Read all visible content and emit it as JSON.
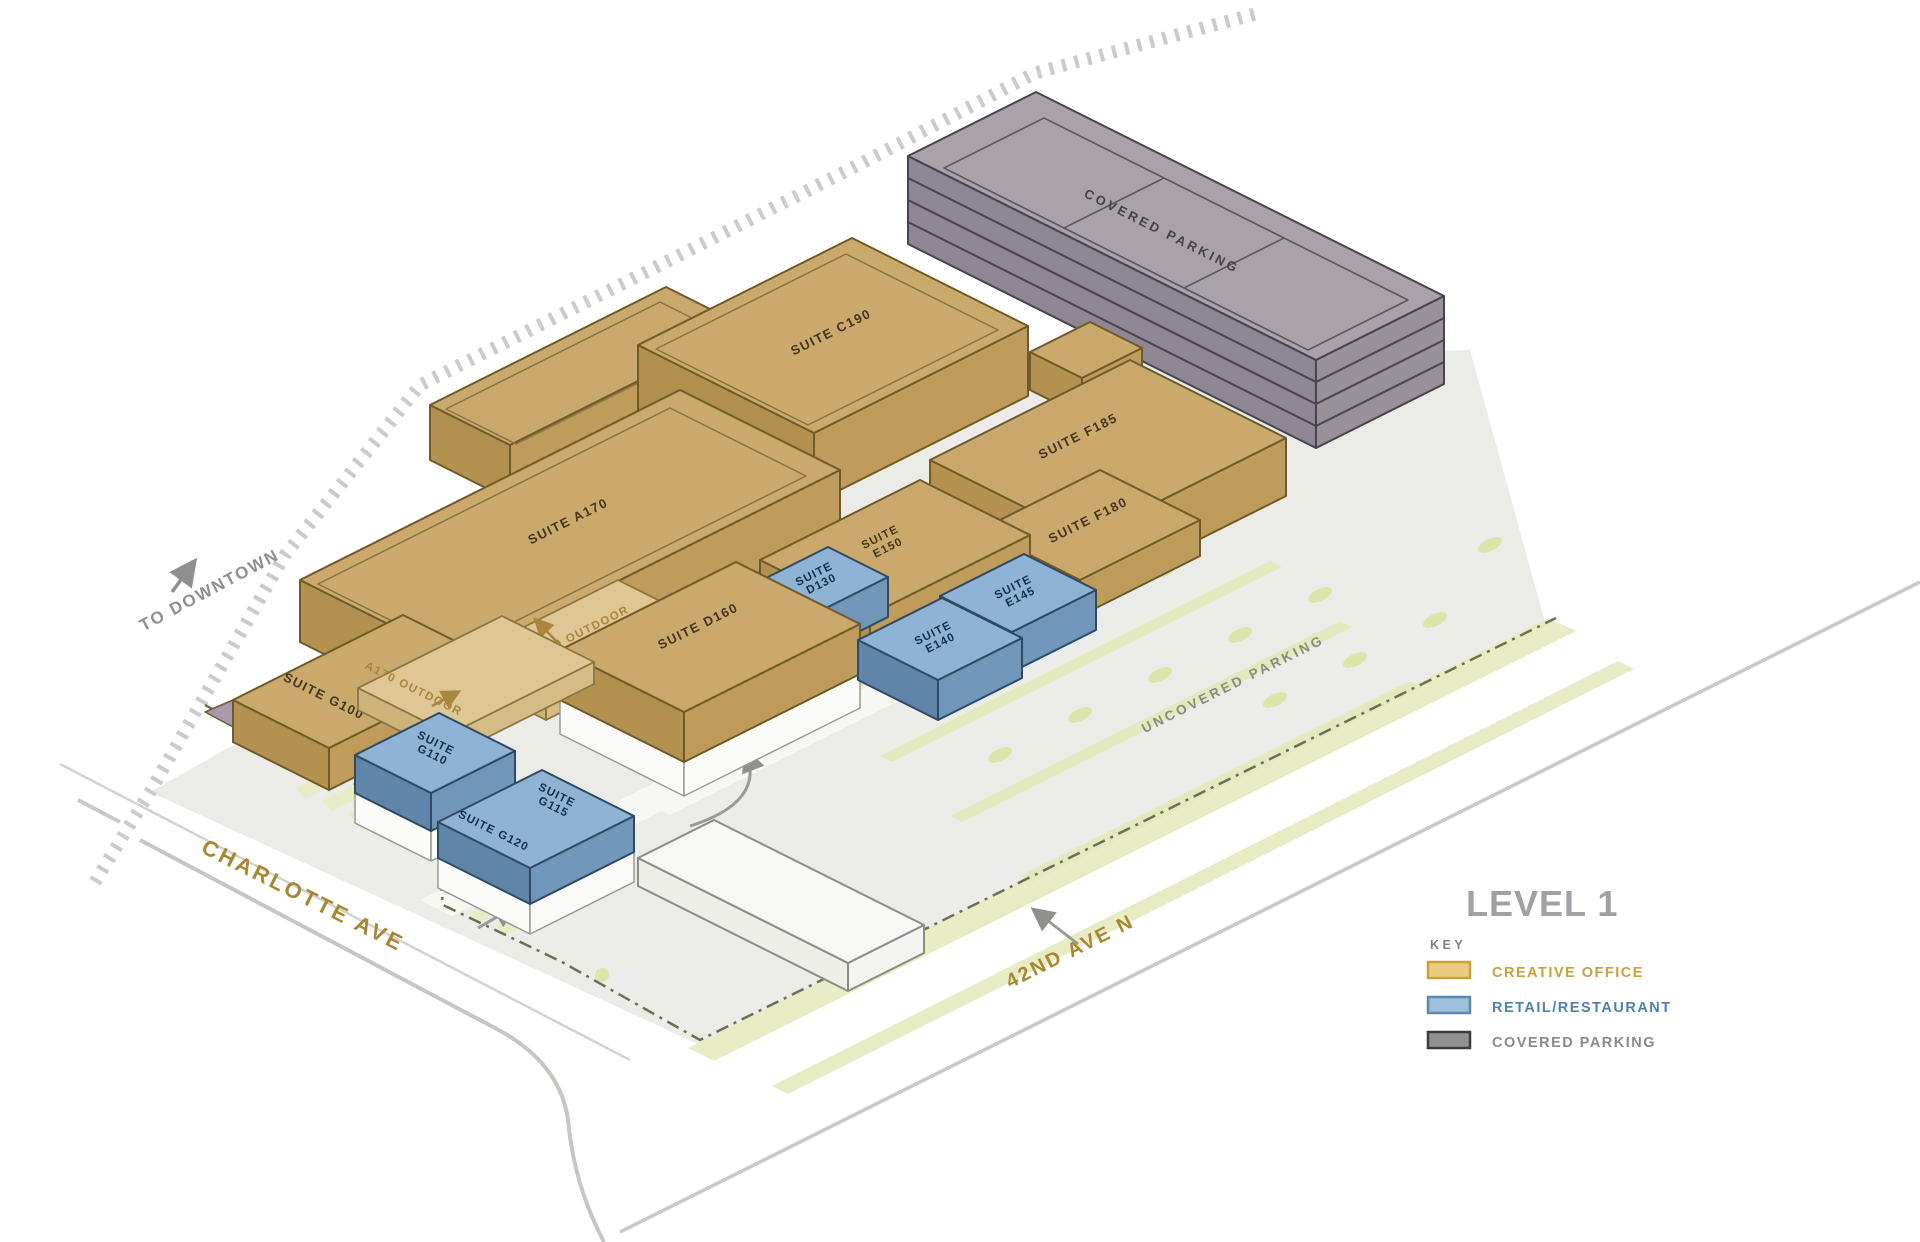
{
  "plan": {
    "level_title": "LEVEL 1",
    "key_label": "KEY",
    "legend": [
      {
        "label": "CREATIVE OFFICE",
        "swatch_fill": "#E9CD80",
        "swatch_border": "#C9A035",
        "text_color": "#C8A13B"
      },
      {
        "label": "RETAIL/RESTAURANT",
        "swatch_fill": "#9CC0DE",
        "swatch_border": "#5E87AC",
        "text_color": "#4C7FB2"
      },
      {
        "label": "COVERED PARKING",
        "swatch_fill": "#919191",
        "swatch_border": "#3A3A3A",
        "text_color": "#8A8A8A"
      }
    ]
  },
  "streets": {
    "charlotte_ave": "CHARLOTTE AVE",
    "forty_second_ave": "42ND AVE N",
    "to_downtown": "TO DOWNTOWN"
  },
  "areas": {
    "covered_parking": "COVERED PARKING",
    "uncovered_parking": "UNCOVERED PARKING"
  },
  "labels": {
    "suite_word": "SUITE"
  },
  "suites": {
    "c190": "SUITE C190",
    "a170": "SUITE A170",
    "d160": "SUITE D160",
    "f185": "SUITE F185",
    "f180": "SUITE F180",
    "g100": "SUITE G100",
    "g120": "SUITE G120",
    "e150": "E150",
    "d130": "D130",
    "e140": "E140",
    "e145": "E145",
    "g110": "G110",
    "g115": "G115"
  },
  "outdoor": {
    "a170": "A170 OUTDOOR",
    "d160": "D160 OUTDOOR"
  },
  "palette": {
    "creative_office": "#CBA96C",
    "retail_restaurant": "#8FB3D4",
    "covered_parking": "#A39CA3",
    "street_label_gold": "#A8872F"
  }
}
